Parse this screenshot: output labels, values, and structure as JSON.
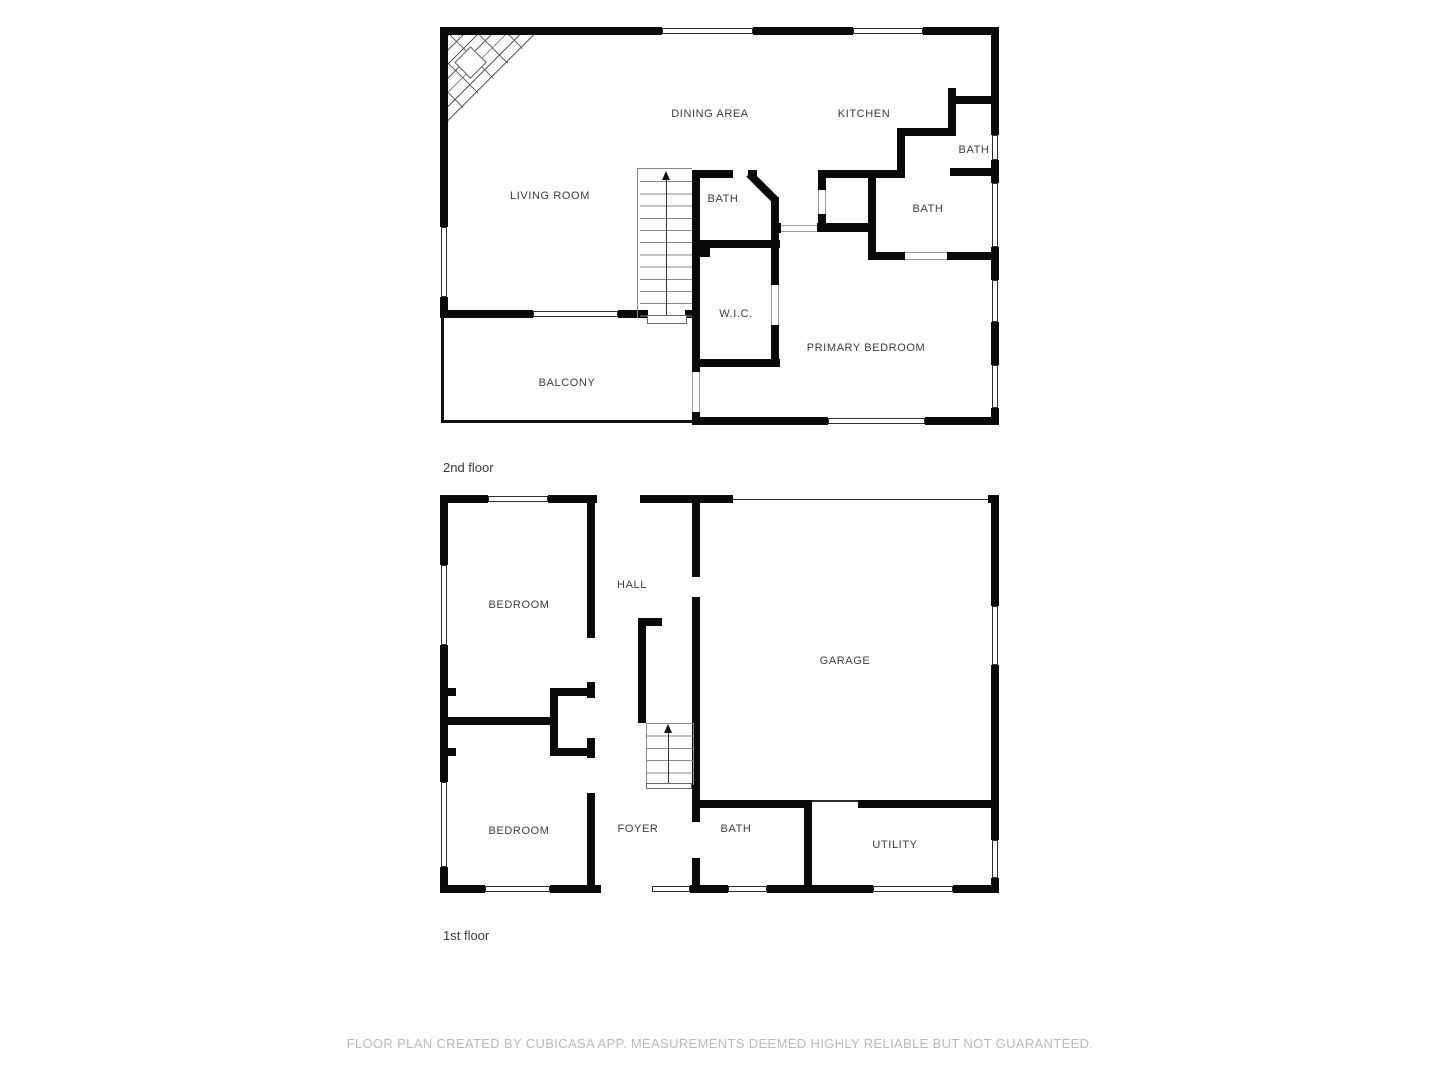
{
  "floors": [
    {
      "caption": "2nd floor",
      "rooms": [
        {
          "label": "LIVING ROOM"
        },
        {
          "label": "DINING AREA"
        },
        {
          "label": "KITCHEN"
        },
        {
          "label": "BATH"
        },
        {
          "label": "BATH"
        },
        {
          "label": "BATH"
        },
        {
          "label": "W.I.C."
        },
        {
          "label": "PRIMARY BEDROOM"
        },
        {
          "label": "BALCONY"
        }
      ]
    },
    {
      "caption": "1st floor",
      "rooms": [
        {
          "label": "BEDROOM"
        },
        {
          "label": "HALL"
        },
        {
          "label": "GARAGE"
        },
        {
          "label": "BEDROOM"
        },
        {
          "label": "FOYER"
        },
        {
          "label": "BATH"
        },
        {
          "label": "UTILITY"
        }
      ]
    }
  ],
  "footer": "FLOOR PLAN CREATED BY CUBICASA APP. MEASUREMENTS DEEMED HIGHLY RELIABLE BUT NOT GUARANTEED.",
  "colors": {
    "wall": "#0a0a0a",
    "railing": "#111111",
    "label": "#3b3b3b",
    "footer": "#b9b9b9"
  }
}
